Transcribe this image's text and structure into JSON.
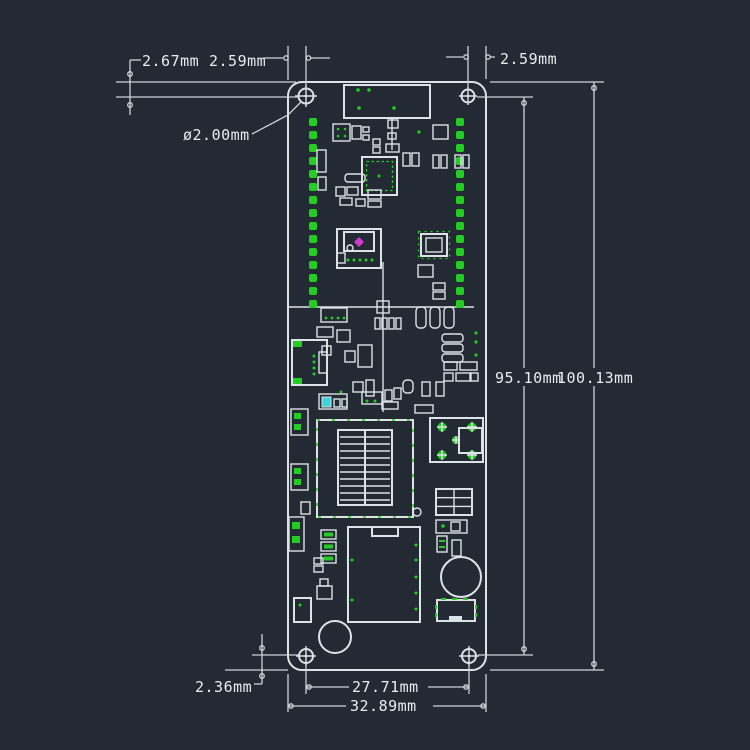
{
  "dimensions": {
    "edge_offset_top": "2.67mm",
    "hole_offset_top_left": "2.59mm",
    "hole_offset_top_right": "2.59mm",
    "hole_diameter": "ø2.00mm",
    "holes_span_vertical": "95.10mm",
    "board_height": "100.13mm",
    "edge_offset_bottom": "2.36mm",
    "holes_span_horizontal": "27.71mm",
    "board_width": "32.89mm"
  },
  "colors": {
    "background": "#232a33",
    "outline": "#dde2e7",
    "dimension_line": "#ccd3d9",
    "pad_green": "#24cd24",
    "marker_magenta": "#cf3ad4",
    "marker_cyan": "#3ad4da",
    "text": "#e9edf0"
  }
}
